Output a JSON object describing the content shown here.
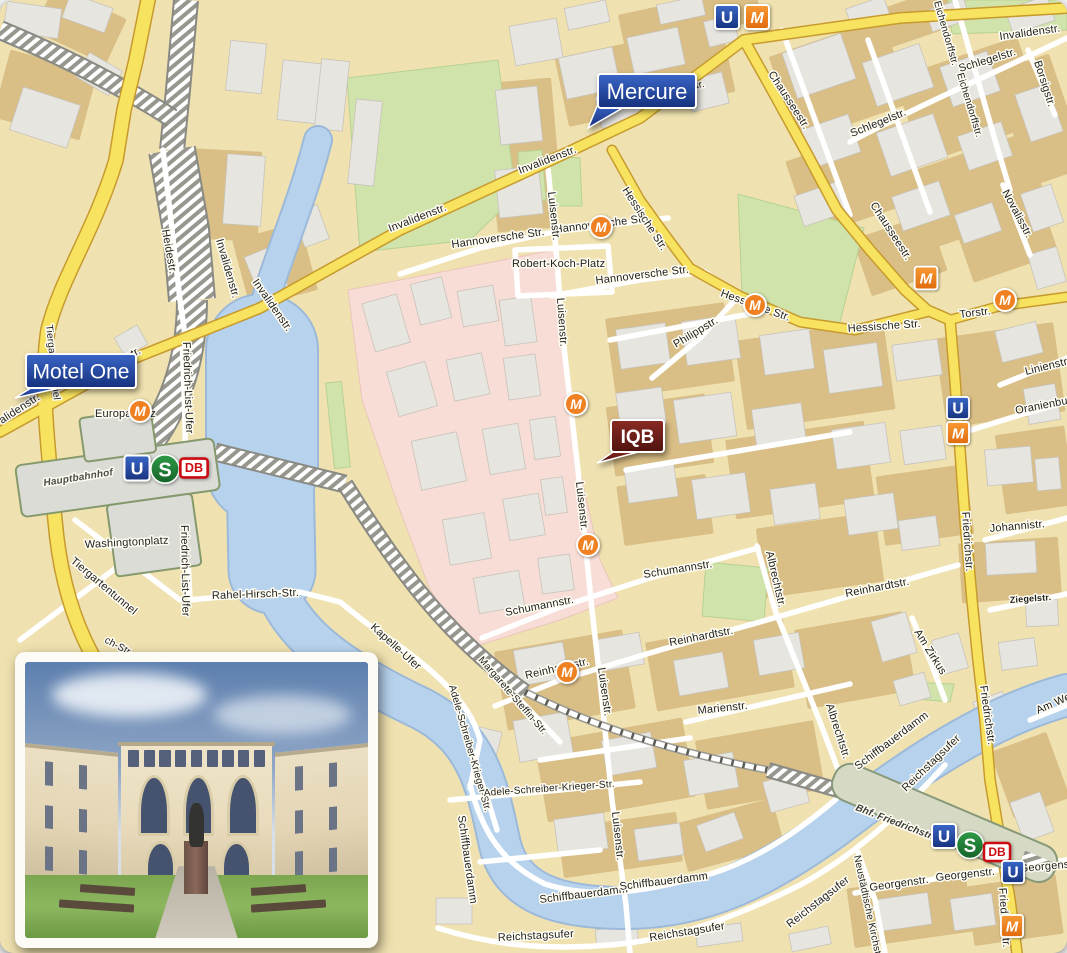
{
  "map": {
    "icon_letters": {
      "u": "U",
      "s": "S",
      "m": "M",
      "db": "DB"
    },
    "colors": {
      "flag_blue_top": "#3a66c8",
      "flag_blue_bottom": "#15307c",
      "flag_maroon_top": "#8a2b24",
      "flag_maroon_bottom": "#4f120e",
      "u_blue": "#1e3f9e",
      "m_orange": "#f08122",
      "s_green": "#1f8136",
      "db_red": "#cc0a12",
      "water": "#b7d2ec",
      "park": "#cfe3ab",
      "hospital_pink": "#f8ddd6",
      "road_yellow": "#f7e35f",
      "building_grey": "#e7e5e0"
    },
    "flags": [
      {
        "id": "mercure",
        "label": "Mercure",
        "x": 598,
        "y": 74,
        "w": 98,
        "h": 34,
        "fs": 22,
        "color": "blue",
        "tail": "598,104 588,128 626,106"
      },
      {
        "id": "motel-one",
        "label": "Motel One",
        "x": 26,
        "y": 354,
        "w": 110,
        "h": 34,
        "fs": 21,
        "color": "blue",
        "tail": "34,386 15,398 64,387"
      },
      {
        "id": "iqb",
        "label": "IQB",
        "x": 611,
        "y": 420,
        "w": 53,
        "h": 32,
        "fs": 19,
        "color": "maroon",
        "tail": "616,450 597,463 642,451",
        "bold": 1
      }
    ],
    "labels": [
      {
        "t": "alidenstr.",
        "x": 2,
        "y": 424,
        "r": -33
      },
      {
        "t": "str.",
        "x": 128,
        "y": 360,
        "r": -28
      },
      {
        "t": "Invalidenstr.",
        "x": 390,
        "y": 232,
        "r": -21
      },
      {
        "t": "Invalidenstr.",
        "x": 520,
        "y": 174,
        "r": -21
      },
      {
        "t": "Invalidenstr.",
        "x": 1000,
        "y": 40,
        "r": -8
      },
      {
        "t": "enstr.",
        "x": 680,
        "y": 92,
        "r": -12,
        "s": 10
      },
      {
        "t": "Heidestr.",
        "x": 162,
        "y": 230,
        "r": 80
      },
      {
        "t": "Invalidenstr.",
        "x": 216,
        "y": 240,
        "r": 74
      },
      {
        "t": "Invalidenstr.",
        "x": 252,
        "y": 282,
        "r": 55
      },
      {
        "t": "Tiergartentunnel",
        "x": 46,
        "y": 325,
        "r": 84,
        "s": 10
      },
      {
        "t": "Tiergartentunnel",
        "x": 70,
        "y": 562,
        "r": 40
      },
      {
        "t": "Europaplatz",
        "x": 95,
        "y": 417
      },
      {
        "t": "Hauptbahnhof",
        "x": 44,
        "y": 486,
        "r": -9,
        "s": 10,
        "b": 1,
        "i": 1,
        "c": "#4a4a46"
      },
      {
        "t": "Washingtonplatz",
        "x": 85,
        "y": 548,
        "r": -3
      },
      {
        "t": "Friedrich-List-Ufer",
        "x": 183,
        "y": 342,
        "r": 88
      },
      {
        "t": "Friedrich-List-Ufer",
        "x": 181,
        "y": 525,
        "r": 89
      },
      {
        "t": "Rahel-Hirsch-Str.",
        "x": 212,
        "y": 599,
        "r": -2
      },
      {
        "t": "ch-Str.",
        "x": 104,
        "y": 642,
        "r": 28,
        "s": 10
      },
      {
        "t": "Kapelle-Ufer",
        "x": 370,
        "y": 628,
        "r": 42
      },
      {
        "t": "Hannoversche Str.",
        "x": 452,
        "y": 248,
        "r": -8
      },
      {
        "t": "Hannoversche Str.",
        "x": 555,
        "y": 233,
        "r": -7
      },
      {
        "t": "Robert-Koch-Platz",
        "x": 512,
        "y": 267
      },
      {
        "t": "Hannoversche Str.",
        "x": 596,
        "y": 284,
        "r": -7
      },
      {
        "t": "Luisenstr.",
        "x": 548,
        "y": 192,
        "r": 84
      },
      {
        "t": "Luisenstr.",
        "x": 557,
        "y": 298,
        "r": 86
      },
      {
        "t": "Luisenstr.",
        "x": 576,
        "y": 482,
        "r": 84
      },
      {
        "t": "Luisenstr.",
        "x": 598,
        "y": 668,
        "r": 82
      },
      {
        "t": "Luisenstr.",
        "x": 612,
        "y": 812,
        "r": 84
      },
      {
        "t": "Hessische Str.",
        "x": 622,
        "y": 190,
        "r": 57
      },
      {
        "t": "Hessische Str.",
        "x": 720,
        "y": 296,
        "r": 20
      },
      {
        "t": "Hessische Str.",
        "x": 848,
        "y": 332,
        "r": -4
      },
      {
        "t": "Philippstr.",
        "x": 676,
        "y": 348,
        "r": -31
      },
      {
        "t": "Chausseestr.",
        "x": 768,
        "y": 74,
        "r": 57
      },
      {
        "t": "Chausseestr.",
        "x": 870,
        "y": 205,
        "r": 57
      },
      {
        "t": "Torstr.",
        "x": 960,
        "y": 318,
        "r": -7
      },
      {
        "t": "Schlegelstr.",
        "x": 852,
        "y": 137,
        "r": -22
      },
      {
        "t": "Schlegelstr.",
        "x": 960,
        "y": 72,
        "r": -17
      },
      {
        "t": "Borsigstr.",
        "x": 1034,
        "y": 62,
        "r": 72
      },
      {
        "t": "Eichendorffstr.",
        "x": 934,
        "y": 2,
        "r": 74,
        "s": 10
      },
      {
        "t": "Eichendorffstr.",
        "x": 957,
        "y": 74,
        "r": 73,
        "s": 10
      },
      {
        "t": "Novalisstr.",
        "x": 1002,
        "y": 192,
        "r": 62
      },
      {
        "t": "Linienstr.",
        "x": 1026,
        "y": 375,
        "r": -14
      },
      {
        "t": "Oranienburger Str.",
        "x": 1016,
        "y": 414,
        "r": -11
      },
      {
        "t": "Friedrichstr.",
        "x": 962,
        "y": 512,
        "r": 86
      },
      {
        "t": "Friedrichstr.",
        "x": 980,
        "y": 686,
        "r": 82
      },
      {
        "t": "Friedrichstr.",
        "x": 999,
        "y": 888,
        "r": 86
      },
      {
        "t": "Johannistr.",
        "x": 990,
        "y": 532,
        "r": -5
      },
      {
        "t": "Ziegelstr.",
        "x": 1010,
        "y": 603,
        "r": -4,
        "s": 9,
        "b": 1
      },
      {
        "t": "Am Zirkus",
        "x": 914,
        "y": 632,
        "r": 58
      },
      {
        "t": "Reinhardtstr.",
        "x": 846,
        "y": 597,
        "r": -11
      },
      {
        "t": "Reinhardtstr.",
        "x": 670,
        "y": 646,
        "r": -11
      },
      {
        "t": "Reinhardtstr.",
        "x": 526,
        "y": 679,
        "r": -13
      },
      {
        "t": "Schumannstr.",
        "x": 644,
        "y": 578,
        "r": -9
      },
      {
        "t": "Schumannstr.",
        "x": 506,
        "y": 616,
        "r": -11
      },
      {
        "t": "Albrechtstr.",
        "x": 766,
        "y": 552,
        "r": 77
      },
      {
        "t": "Albrechtstr.",
        "x": 826,
        "y": 705,
        "r": 72
      },
      {
        "t": "Marienstr.",
        "x": 698,
        "y": 714,
        "r": -6
      },
      {
        "t": "Margarete-Steffin-Str.",
        "x": 478,
        "y": 660,
        "r": 49,
        "s": 10
      },
      {
        "t": "Adele-Schreiber-Krieger-Str.",
        "x": 449,
        "y": 686,
        "r": 74,
        "s": 10
      },
      {
        "t": "Adele-Schreiber-Krieger-Str.",
        "x": 484,
        "y": 796,
        "r": -4,
        "s": 10
      },
      {
        "t": "Schiffbauerdamm",
        "x": 458,
        "y": 816,
        "r": 82
      },
      {
        "t": "Schiffbauerdamm",
        "x": 540,
        "y": 903,
        "r": -7
      },
      {
        "t": "Schiffbauerdamm",
        "x": 620,
        "y": 890,
        "r": -7
      },
      {
        "t": "Schiffbauerdamm",
        "x": 858,
        "y": 770,
        "r": -37
      },
      {
        "t": "Reichstagsufer",
        "x": 498,
        "y": 941,
        "r": -3
      },
      {
        "t": "Reichstagsufer",
        "x": 650,
        "y": 941,
        "r": -9
      },
      {
        "t": "Reichstagsufer",
        "x": 790,
        "y": 928,
        "r": -38
      },
      {
        "t": "Reichstagsufer",
        "x": 906,
        "y": 792,
        "r": -44
      },
      {
        "t": "Georgenstr.",
        "x": 870,
        "y": 891,
        "r": -8
      },
      {
        "t": "Georgenstr.",
        "x": 936,
        "y": 881,
        "r": -6
      },
      {
        "t": "Georgenstr.",
        "x": 1020,
        "y": 872,
        "r": -5
      },
      {
        "t": "Neustädtische Kirchstr.",
        "x": 854,
        "y": 856,
        "r": 78,
        "s": 10
      },
      {
        "t": "Bhf. Friedrichstr.",
        "x": 855,
        "y": 810,
        "r": 21,
        "s": 10,
        "b": 1,
        "i": 1,
        "c": "#3c3c38"
      },
      {
        "t": "Am Weidendamm",
        "x": 1038,
        "y": 714,
        "r": -24
      }
    ],
    "icons": [
      {
        "k": "u-sq",
        "x": 727,
        "y": 17
      },
      {
        "k": "m-sq",
        "x": 757,
        "y": 17
      },
      {
        "k": "m-c",
        "x": 140,
        "y": 411
      },
      {
        "k": "m-c",
        "x": 601,
        "y": 227
      },
      {
        "k": "m-c",
        "x": 755,
        "y": 305
      },
      {
        "k": "m-sq",
        "x": 926,
        "y": 278,
        "sc": 0.95
      },
      {
        "k": "m-c",
        "x": 1005,
        "y": 300
      },
      {
        "k": "u-sq",
        "x": 958,
        "y": 408,
        "sc": 0.92
      },
      {
        "k": "m-sq",
        "x": 958,
        "y": 433,
        "sc": 0.92
      },
      {
        "k": "m-c",
        "x": 576,
        "y": 404
      },
      {
        "k": "m-c",
        "x": 588,
        "y": 545
      },
      {
        "k": "m-c",
        "x": 567,
        "y": 672
      },
      {
        "k": "u-sq",
        "x": 137,
        "y": 468,
        "sc": 1.05
      },
      {
        "k": "s-c",
        "x": 165,
        "y": 469,
        "sc": 1.05
      },
      {
        "k": "db",
        "x": 194,
        "y": 468,
        "sc": 1.05
      },
      {
        "k": "u-sq",
        "x": 944,
        "y": 836
      },
      {
        "k": "s-c",
        "x": 970,
        "y": 845
      },
      {
        "k": "db",
        "x": 997,
        "y": 852
      },
      {
        "k": "u-sq",
        "x": 1013,
        "y": 872,
        "sc": 0.92
      },
      {
        "k": "m-sq",
        "x": 1012,
        "y": 926,
        "sc": 0.92
      }
    ]
  }
}
